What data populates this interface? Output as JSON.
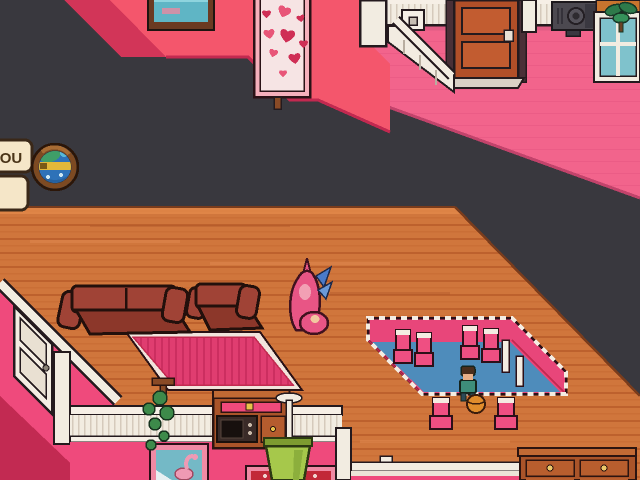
{
  "hud": {
    "you_label": "YOU",
    "globe_icon": "globe-icon",
    "panel_icon": "blank-panel"
  },
  "palette": {
    "void": "#39383e",
    "wall_pink": "#f4566c",
    "wall_pink_shadow": "#d23558",
    "upper_floor_pink": "#f2648c",
    "wood_floor": "#d0763c",
    "wood_line": "#bd612d",
    "trim_white": "#f2ece1",
    "outline_dark": "#241a1e",
    "couch_red": "#a04336",
    "rug_pink": "#e03d70",
    "pit_wall_pink": "#e8467a",
    "pit_floor_blue": "#4e8cbb",
    "chair_pink": "#ef4f82",
    "south_wall_pink": "#ef4a7c",
    "door_wood_brown": "#b14f28",
    "window_glass_teal": "#7fc2cc",
    "plant_green": "#3d8a4a",
    "bucket_green": "#a6c84b",
    "dresser_brown": "#aa5429",
    "ball_orange": "#e08c2c",
    "hud_cream": "#f5e6c8",
    "hud_border_brown": "#3a2818"
  },
  "scene": {
    "objects": [
      "top-left-pink-wall",
      "teal-painting",
      "hearts-painting",
      "staircase",
      "upper-room-pink-floor",
      "wainscot-railing",
      "wall-outlet",
      "wooden-door",
      "projector",
      "window-with-palm",
      "wood-plank-floor",
      "couch",
      "armchair",
      "pink-striped-rug",
      "player-character",
      "sunken-conversation-pit",
      "pit-chairs",
      "npc-with-ball",
      "white-side-door",
      "south-railing",
      "hanging-plant",
      "microwave-hutch",
      "hanging-bucket-planter",
      "flamingo-painting",
      "red-painting",
      "drawer-dresser"
    ]
  }
}
